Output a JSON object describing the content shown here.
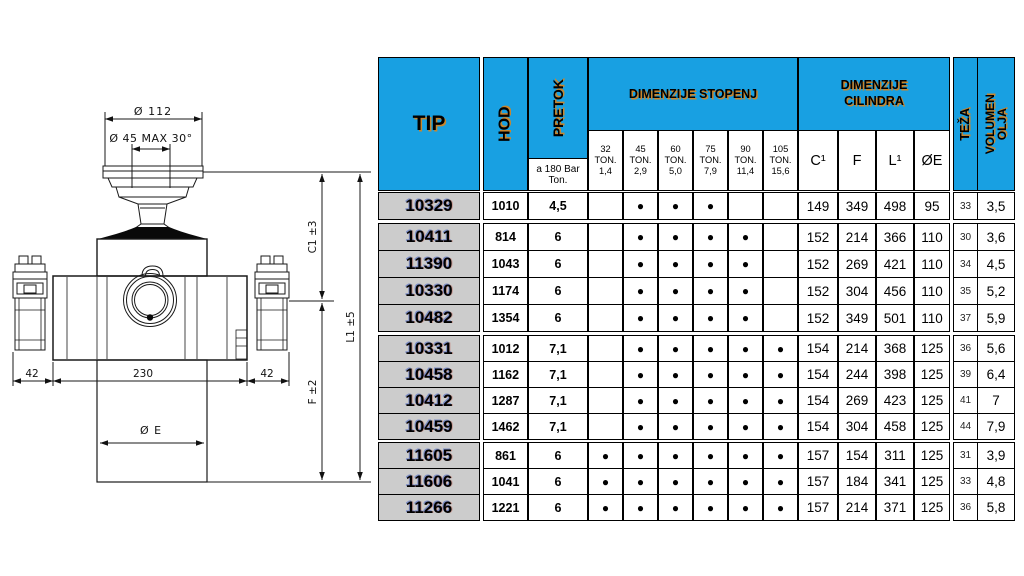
{
  "drawing": {
    "dim_top_diameter": "Ø 112",
    "dim_ball": "Ø 45  MAX 30°",
    "dim_c1": "C1  ±3",
    "dim_l1": "L1  ±5",
    "dim_f": "F  ±2",
    "dim_left_offset": "42",
    "dim_body_width": "230",
    "dim_right_offset": "42",
    "dim_cyl_diameter": "Ø E"
  },
  "table": {
    "header": {
      "tip": "TIP",
      "hod": "HOD",
      "pretok": "PRETOK",
      "pretok_sub": "a 180 Bar Ton.",
      "stopenj_title": "DIMENZIJE STOPENJ",
      "stopenj_cols": [
        {
          "ton": "32",
          "unit": "TON.",
          "cap": "1,4"
        },
        {
          "ton": "45",
          "unit": "TON.",
          "cap": "2,9"
        },
        {
          "ton": "60",
          "unit": "TON.",
          "cap": "5,0"
        },
        {
          "ton": "75",
          "unit": "TON.",
          "cap": "7,9"
        },
        {
          "ton": "90",
          "unit": "TON.",
          "cap": "11,4"
        },
        {
          "ton": "105",
          "unit": "TON.",
          "cap": "15,6"
        }
      ],
      "cilindra_title": "DIMENZIJE CILINDRA",
      "cilindra_cols": [
        "C¹",
        "F",
        "L¹",
        "ØE"
      ],
      "teza": "TEŽA",
      "volumen_line1": "VOLUMEN",
      "volumen_line2": "OLJA"
    },
    "groups": [
      [
        {
          "tip": "10329",
          "hod": "1010",
          "pretok": "4,5",
          "stages": [
            false,
            true,
            true,
            true,
            false,
            false
          ],
          "c1": "149",
          "f": "349",
          "l1": "498",
          "oe": "95",
          "teza": "33",
          "volumen": "3,5"
        }
      ],
      [
        {
          "tip": "10411",
          "hod": "814",
          "pretok": "6",
          "stages": [
            false,
            true,
            true,
            true,
            true,
            false
          ],
          "c1": "152",
          "f": "214",
          "l1": "366",
          "oe": "110",
          "teza": "30",
          "volumen": "3,6"
        },
        {
          "tip": "11390",
          "hod": "1043",
          "pretok": "6",
          "stages": [
            false,
            true,
            true,
            true,
            true,
            false
          ],
          "c1": "152",
          "f": "269",
          "l1": "421",
          "oe": "110",
          "teza": "34",
          "volumen": "4,5"
        },
        {
          "tip": "10330",
          "hod": "1174",
          "pretok": "6",
          "stages": [
            false,
            true,
            true,
            true,
            true,
            false
          ],
          "c1": "152",
          "f": "304",
          "l1": "456",
          "oe": "110",
          "teza": "35",
          "volumen": "5,2"
        },
        {
          "tip": "10482",
          "hod": "1354",
          "pretok": "6",
          "stages": [
            false,
            true,
            true,
            true,
            true,
            false
          ],
          "c1": "152",
          "f": "349",
          "l1": "501",
          "oe": "110",
          "teza": "37",
          "volumen": "5,9"
        }
      ],
      [
        {
          "tip": "10331",
          "hod": "1012",
          "pretok": "7,1",
          "stages": [
            false,
            true,
            true,
            true,
            true,
            true
          ],
          "c1": "154",
          "f": "214",
          "l1": "368",
          "oe": "125",
          "teza": "36",
          "volumen": "5,6"
        },
        {
          "tip": "10458",
          "hod": "1162",
          "pretok": "7,1",
          "stages": [
            false,
            true,
            true,
            true,
            true,
            true
          ],
          "c1": "154",
          "f": "244",
          "l1": "398",
          "oe": "125",
          "teza": "39",
          "volumen": "6,4"
        },
        {
          "tip": "10412",
          "hod": "1287",
          "pretok": "7,1",
          "stages": [
            false,
            true,
            true,
            true,
            true,
            true
          ],
          "c1": "154",
          "f": "269",
          "l1": "423",
          "oe": "125",
          "teza": "41",
          "volumen": "7"
        },
        {
          "tip": "10459",
          "hod": "1462",
          "pretok": "7,1",
          "stages": [
            false,
            true,
            true,
            true,
            true,
            true
          ],
          "c1": "154",
          "f": "304",
          "l1": "458",
          "oe": "125",
          "teza": "44",
          "volumen": "7,9"
        }
      ],
      [
        {
          "tip": "11605",
          "hod": "861",
          "pretok": "6",
          "stages": [
            true,
            true,
            true,
            true,
            true,
            true
          ],
          "c1": "157",
          "f": "154",
          "l1": "311",
          "oe": "125",
          "teza": "31",
          "volumen": "3,9"
        },
        {
          "tip": "11606",
          "hod": "1041",
          "pretok": "6",
          "stages": [
            true,
            true,
            true,
            true,
            true,
            true
          ],
          "c1": "157",
          "f": "184",
          "l1": "341",
          "oe": "125",
          "teza": "33",
          "volumen": "4,8"
        },
        {
          "tip": "11266",
          "hod": "1221",
          "pretok": "6",
          "stages": [
            true,
            true,
            true,
            true,
            true,
            true
          ],
          "c1": "157",
          "f": "214",
          "l1": "371",
          "oe": "125",
          "teza": "36",
          "volumen": "5,8"
        }
      ]
    ]
  },
  "colors": {
    "header_blue": "#18a0e2",
    "tip_gray": "#cccccc",
    "header_text_shadow": "#c8862e",
    "dot": "#000000"
  }
}
